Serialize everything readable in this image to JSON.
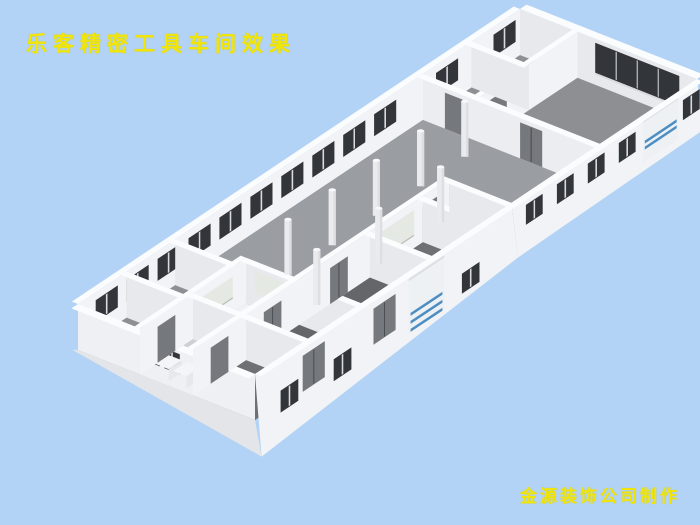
{
  "page": {
    "background_color": "#b2d3f5"
  },
  "title": {
    "text": "乐客精密工具车间效果",
    "color": "#f2e606"
  },
  "credit": {
    "text": "金源装饰公司制作",
    "color": "#f2e606"
  },
  "scene": {
    "description": "3D bird's-eye rendering of a precision tool workshop floor plan: long open hall with two rows of round pillars, office/bathroom rooms at the south-west end, workrooms along the south edge, offices at the north-east end, dark strip windows along the walls and two blue-striped roller shutter doors on the south-east wall",
    "colors": {
      "wall_lit": "#f1f3f6",
      "wall_shaded": "#e7e9ed",
      "wall_exterior": "#e3e5e9",
      "wall_cap": "#fbfcfe",
      "floor_main": "#9a9da1",
      "floor_ne_rooms": "#8d8f93",
      "floor_room_dark": "#646669",
      "floor_room_mid": "#6e7073",
      "floor_bathroom": "#ced1d4",
      "floor_landing": "#f2f3f5",
      "window_dark": "#32353a",
      "window_frame": "#d8dade",
      "glass_frosted": "#e4e9e3",
      "glass_frosted_frame": "#b9bfba",
      "door_gray": "#75787c",
      "door_gap": "#4a4d51",
      "roller_door_panel": "#eef1f4",
      "roller_door_stripe": "#4d8ec2",
      "pillar": "#e9ebee",
      "pillar_top": "#f7f8fa"
    },
    "elements": {
      "pillar_count": 8,
      "far_wall_window_count": 12,
      "near_wall_window_count": 8,
      "roller_door_count": 2,
      "interior_door_count": 9,
      "frosted_window_count": 4,
      "bathroom_sink_count": 2
    }
  }
}
